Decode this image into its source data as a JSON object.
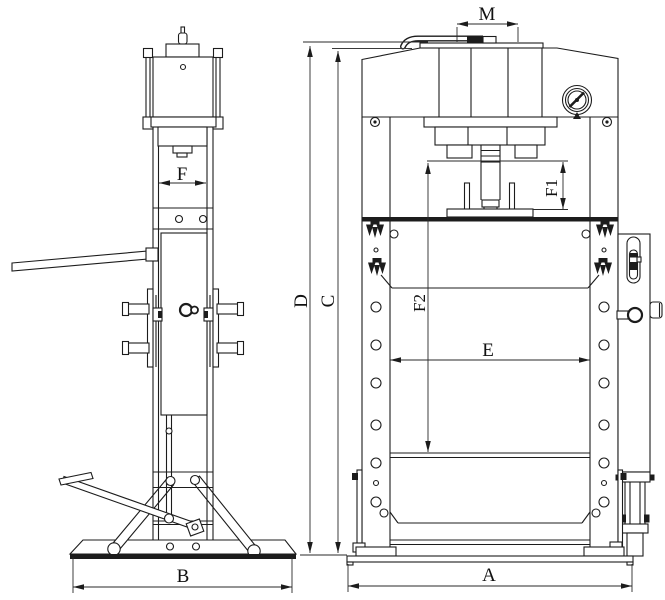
{
  "canvas": {
    "background": "#ffffff",
    "line_color": "#1c1c1c"
  },
  "drawing": {
    "type": "technical line drawing",
    "subject": "hydraulic shop press shown in two orthographic views",
    "left_view": "side elevation with pump handle, foot pedal linkage and support struts",
    "right_view": "front elevation with press head, pressure gauge, hand pump, perforated columns, work table and lower shelf"
  },
  "dimensions": {
    "A": "A",
    "B": "B",
    "C": "C",
    "D": "D",
    "E": "E",
    "F": "F",
    "F1": "F1",
    "F2": "F2",
    "M": "M"
  }
}
